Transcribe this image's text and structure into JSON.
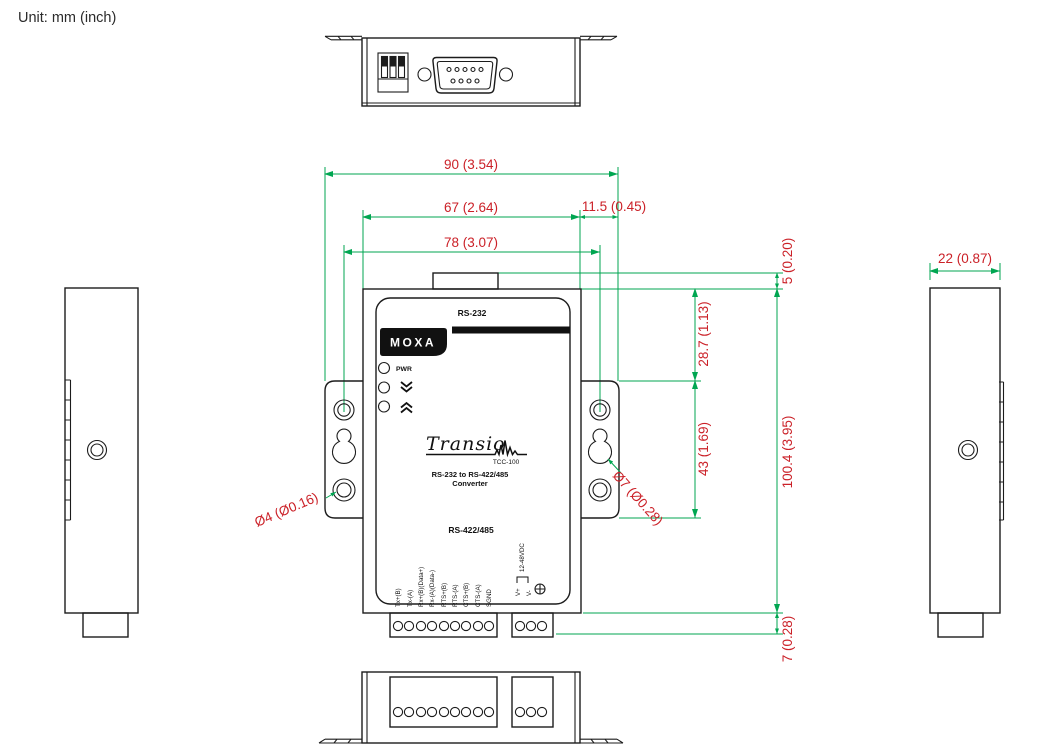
{
  "title": {
    "unit_label": "Unit: mm (inch)"
  },
  "colors": {
    "dimension_line": "#00a651",
    "dimension_text": "#cb2128",
    "outline": "#1c1c1c",
    "panel_print": "#111111"
  },
  "front_panel": {
    "interface_top": "RS-232",
    "brand": "MOXA",
    "led_power": "PWR",
    "product_name": "Transio",
    "model": "TCC-100",
    "description_line1": "RS-232 to RS-422/485",
    "description_line2": "Converter",
    "interface_bottom": "RS-422/485",
    "terminals": [
      "Tx+(B)",
      "Tx-(A)",
      "Rx+(B)(Data+)",
      "Rx-(A)(Data-)",
      "RTS+(B)",
      "RTS-(A)",
      "CTS+(B)",
      "CTS-(A)",
      "SGND"
    ],
    "power": {
      "v_plus": "V+",
      "v_minus": "V-",
      "voltage_range": "12-48VDC"
    }
  },
  "dimensions": {
    "overall_width": "90 (3.54)",
    "body_width": "67 (2.64)",
    "ear_overhang": "11.5 (0.45)",
    "mount_hole_spacing": "78 (3.07)",
    "connector_protrusion": "5 (0.20)",
    "top_to_ear": "28.7 (1.13)",
    "ear_height": "43 (1.69)",
    "body_height": "100.4 (3.95)",
    "terminal_depth": "7 (0.28)",
    "depth": "22 (0.87)",
    "screw_hole_dia": "Ø4 (Ø0.16)",
    "keyhole_dia": "Ø7 (Ø0.28)"
  }
}
